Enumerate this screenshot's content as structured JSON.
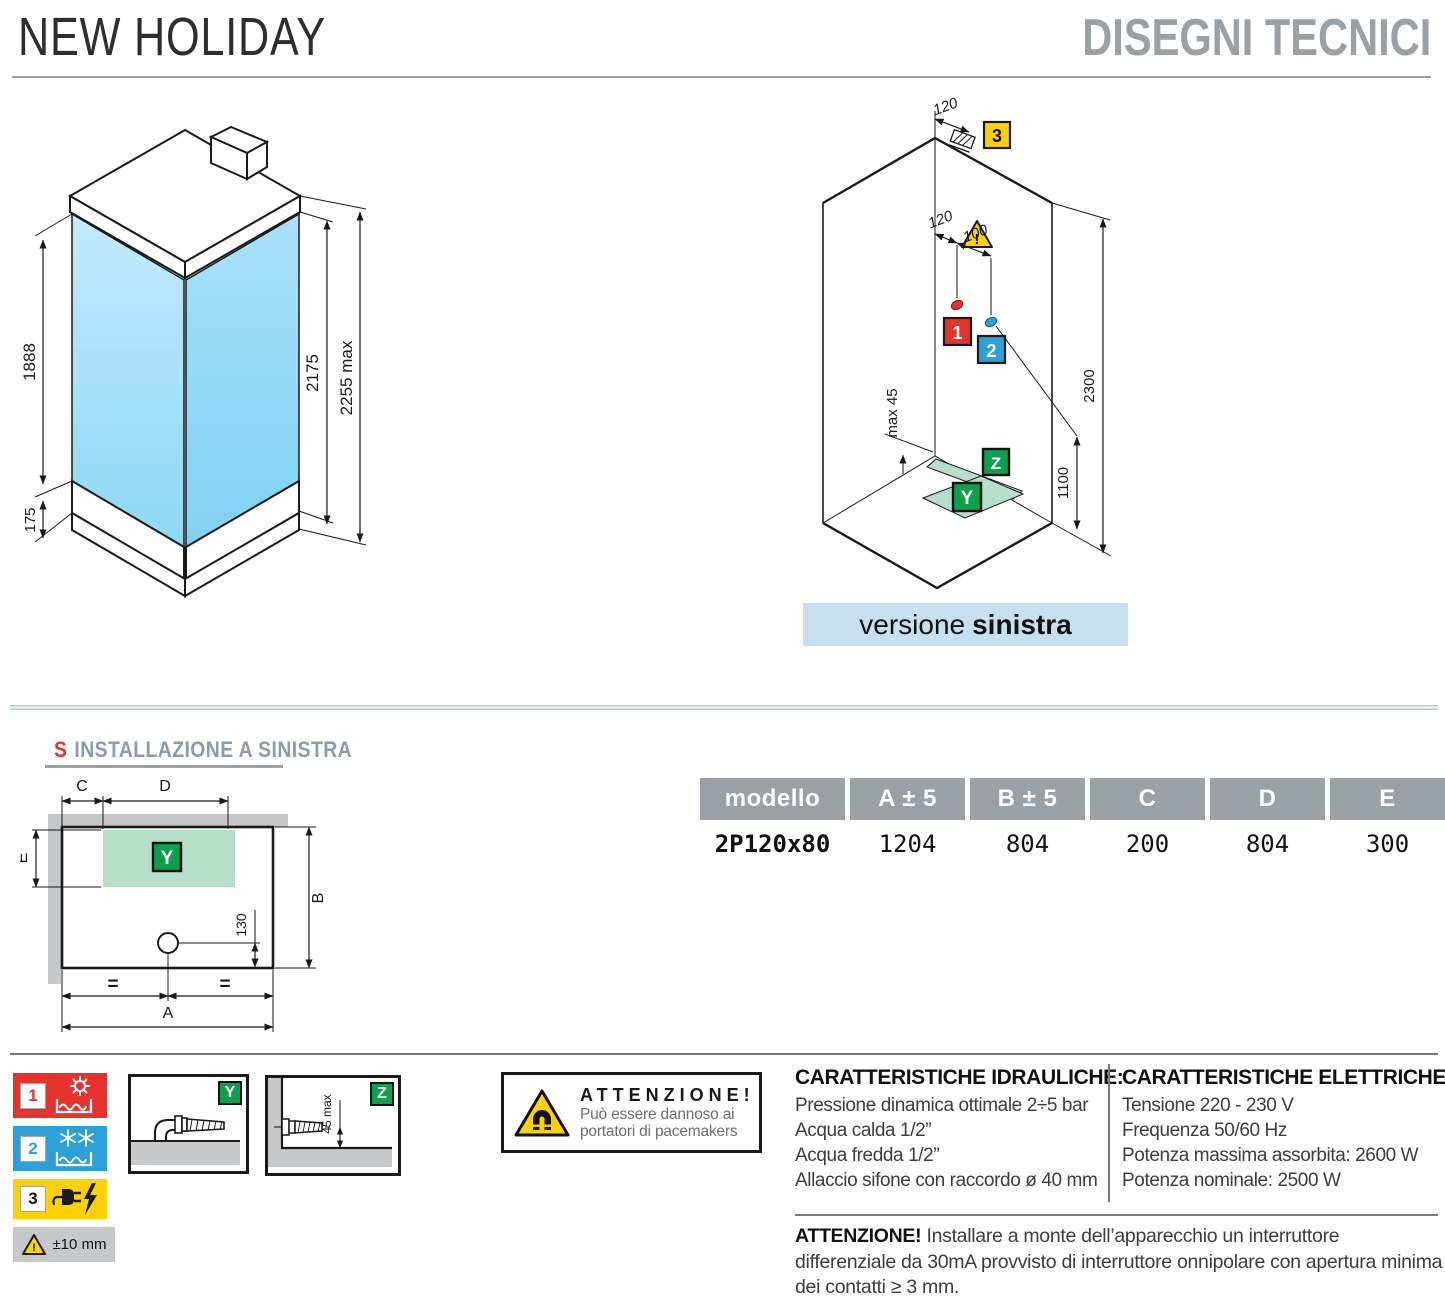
{
  "header": {
    "title": "NEW HOLIDAY",
    "subtitle": "DISEGNI TECNICI"
  },
  "iso_cabin": {
    "dim_glass_height": "1888",
    "dim_tray_height": "175",
    "dim_inner_height": "2175",
    "dim_max_height": "2255 max"
  },
  "iso_install": {
    "dim_top_offset": "120",
    "dim_hot": "120",
    "dim_cold": "100",
    "dim_ceiling": "2300",
    "dim_connection": "1100",
    "dim_floor_gap": "max 45",
    "marker_hot": "1",
    "marker_cold": "2",
    "marker_power": "3",
    "marker_drain": "Y",
    "marker_inlet": "Z",
    "warning": "!",
    "banner_text": "versione ",
    "banner_bold": "sinistra"
  },
  "plan": {
    "heading_letter": "S",
    "heading_text": "INSTALLAZIONE A SINISTRA",
    "dim_a": "A",
    "dim_b": "B",
    "dim_c": "C",
    "dim_d": "D",
    "dim_e": "E",
    "dim_drain": "130",
    "equal_left": "=",
    "equal_right": "=",
    "marker_drain": "Y"
  },
  "table": {
    "headers": [
      "modello",
      "A ± 5",
      "B ± 5",
      "C",
      "D",
      "E"
    ],
    "row": [
      "2P120x80",
      "1204",
      "804",
      "200",
      "804",
      "300"
    ]
  },
  "legend": {
    "hot": {
      "num": "1"
    },
    "cold": {
      "num": "2"
    },
    "power": {
      "num": "3"
    },
    "tolerance": "±10 mm",
    "warning_mark": "!",
    "detail_y": {
      "label": "Y"
    },
    "detail_z": {
      "label": "Z",
      "dim": "45 max"
    }
  },
  "magnet_warning": {
    "title": "ATTENZIONE!",
    "lines": [
      "Può essere dannoso ai",
      "portatori di pacemakers"
    ]
  },
  "hydraulic": {
    "title": "CARATTERISTICHE IDRAULICHE:",
    "lines": [
      "Pressione dinamica ottimale 2÷5 bar",
      "Acqua calda 1/2”",
      "Acqua fredda 1/2”",
      "Allaccio sifone con raccordo ø 40 mm"
    ]
  },
  "electric": {
    "title": "CARATTERISTICHE ELETTRICHE:",
    "lines": [
      "Tensione 220 - 230 V",
      "Frequenza 50/60 Hz",
      "Potenza massima assorbita: 2600 W",
      "Potenza nominale: 2500 W"
    ]
  },
  "bottom_warning": {
    "title": "ATTENZIONE!",
    "text": "Installare a monte dell’apparecchio un interruttore differenziale da 30mA provvisto di interruttore onnipolare con apertura minima dei contatti ≥ 3 mm."
  },
  "colors": {
    "red": "#e5322d",
    "blue": "#2d9fd9",
    "yellow": "#fcd205",
    "green": "#0da04f",
    "table_header_gray": "#9aa0a4",
    "banner_blue": "#c6e0f0",
    "glass_blue": "#9fdef7",
    "pale_green": "#b5dfc9"
  }
}
